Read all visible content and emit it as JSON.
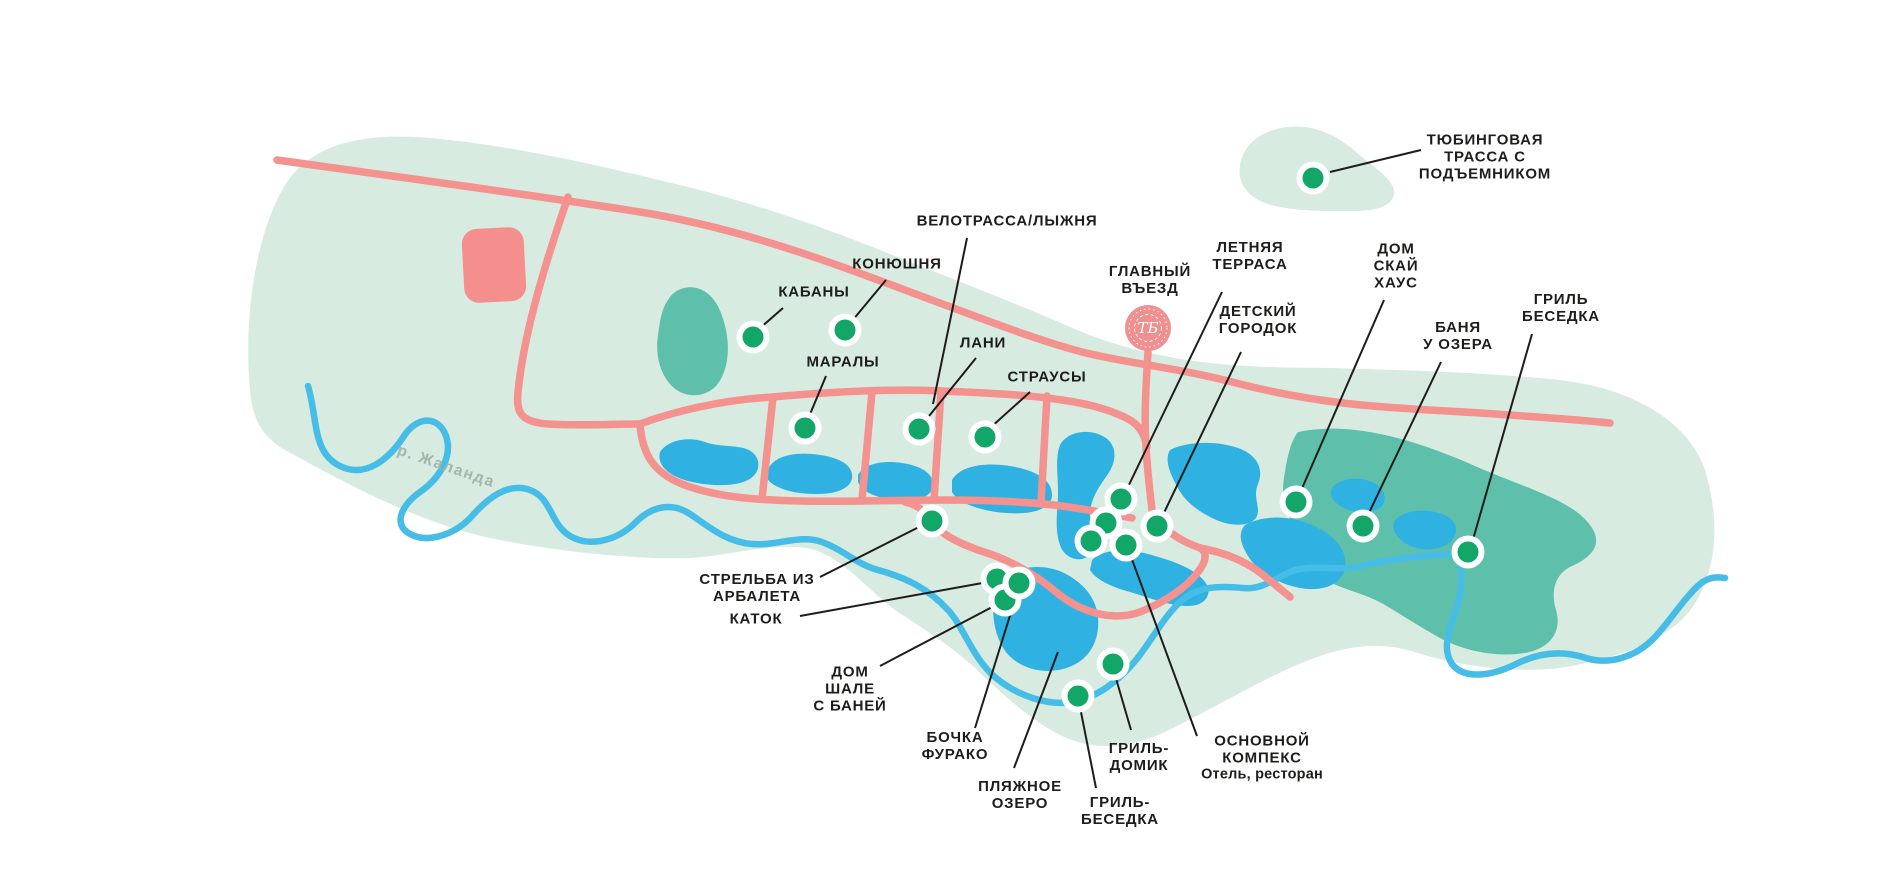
{
  "map": {
    "name": "resort-park-map",
    "colors": {
      "park": "#d8ebe0",
      "forest": "#5ebfab",
      "lake": "#2fb2e2",
      "river": "#45bde7",
      "road": "#f4928f",
      "building": "#f58f8e",
      "logo": "#ee8f90",
      "marker": "#13a669",
      "ring": "#ffffff",
      "text": "#1d1d1b",
      "riverText": "#a3b6a9"
    },
    "river_label": {
      "text": "р. Жаланда",
      "x": 446,
      "y": 467,
      "angle": 19
    },
    "logo": {
      "monogram": "ТБ",
      "x": 1148,
      "y": 328,
      "r": 23
    },
    "markers": [
      {
        "id": "tubing-track",
        "lines": [
          "ТЮБИНГОВАЯ",
          "ТРАССА С",
          "ПОДЪЕМНИКОМ"
        ],
        "label": [
          1485,
          157
        ],
        "leader": [
          1421,
          150,
          1330,
          172
        ],
        "dot": [
          1313,
          178
        ]
      },
      {
        "id": "bike-ski-track",
        "lines": [
          "ВЕЛОТРАССА/ЛЫЖНЯ"
        ],
        "label": [
          1007,
          221
        ],
        "leader": [
          967,
          238,
          933,
          404
        ],
        "dot": null
      },
      {
        "id": "stable",
        "lines": [
          "КОНЮШНЯ"
        ],
        "label": [
          897,
          264
        ],
        "leader": [
          886,
          280,
          852,
          321
        ],
        "dot": [
          845,
          330
        ]
      },
      {
        "id": "boars",
        "lines": [
          "КАБАНЫ"
        ],
        "label": [
          814,
          292
        ],
        "leader": [
          783,
          308,
          759,
          329
        ],
        "dot": [
          753,
          337
        ]
      },
      {
        "id": "marals",
        "lines": [
          "МАРАЛЫ"
        ],
        "label": [
          843,
          362
        ],
        "leader": [
          826,
          376,
          808,
          419
        ],
        "dot": [
          805,
          428
        ]
      },
      {
        "id": "fallow-deer",
        "lines": [
          "ЛАНИ"
        ],
        "label": [
          983,
          343
        ],
        "leader": [
          976,
          358,
          925,
          421
        ],
        "dot": [
          919,
          429
        ]
      },
      {
        "id": "ostriches",
        "lines": [
          "СТРАУСЫ"
        ],
        "label": [
          1047,
          377
        ],
        "leader": [
          1030,
          392,
          990,
          428
        ],
        "dot": [
          985,
          437
        ]
      },
      {
        "id": "main-entrance",
        "lines": [
          "ГЛАВНЫЙ",
          "ВЪЕЗД"
        ],
        "label": [
          1150,
          280
        ],
        "leader": null,
        "dot": null
      },
      {
        "id": "summer-terrace",
        "lines": [
          "ЛЕТНЯЯ",
          "ТЕРРАСА"
        ],
        "label": [
          1250,
          256
        ],
        "leader": [
          1222,
          292,
          1126,
          491
        ],
        "dot": [
          1121,
          499
        ]
      },
      {
        "id": "kids-playground",
        "lines": [
          "ДЕТСКИЙ",
          "ГОРОДОК"
        ],
        "label": [
          1258,
          320
        ],
        "leader": [
          1241,
          352,
          1162,
          517
        ],
        "dot": [
          1157,
          526
        ]
      },
      {
        "id": "sky-house",
        "lines": [
          "ДОМ",
          "СКАЙ",
          "ХАУС"
        ],
        "label": [
          1396,
          266
        ],
        "leader": [
          1384,
          300,
          1300,
          493
        ],
        "dot": [
          1296,
          502
        ]
      },
      {
        "id": "lake-bathhouse",
        "lines": [
          "БАНЯ",
          "У ОЗЕРА"
        ],
        "label": [
          1458,
          336
        ],
        "leader": [
          1441,
          362,
          1367,
          517
        ],
        "dot": [
          1363,
          526
        ]
      },
      {
        "id": "grill-gazebo-east",
        "lines": [
          "ГРИЛЬ",
          "БЕСЕДКА"
        ],
        "label": [
          1561,
          308
        ],
        "leader": [
          1532,
          334,
          1472,
          543
        ],
        "dot": [
          1468,
          552
        ]
      },
      {
        "id": "crossbow-shooting",
        "lines": [
          "СТРЕЛЬБА ИЗ",
          "АРБАЛЕТА"
        ],
        "label": [
          757,
          588
        ],
        "leader": [
          820,
          577,
          923,
          525
        ],
        "dot": [
          932,
          521
        ]
      },
      {
        "id": "skating-rink",
        "lines": [
          "КАТОК"
        ],
        "label": [
          756,
          619
        ],
        "leader": [
          800,
          616,
          988,
          582
        ],
        "dot": [
          997,
          579
        ]
      },
      {
        "id": "chalet-house",
        "lines": [
          "ДОМ",
          "ШАЛЕ",
          "С БАНЕЙ"
        ],
        "label": [
          850,
          689
        ],
        "leader": [
          880,
          666,
          996,
          605
        ],
        "dot": [
          1005,
          600
        ]
      },
      {
        "id": "furako-barrel",
        "lines": [
          "БОЧКА",
          "ФУРАКО"
        ],
        "label": [
          955,
          746
        ],
        "leader": [
          975,
          728,
          1017,
          593
        ],
        "dot": [
          1019,
          583
        ]
      },
      {
        "id": "beach-lake",
        "lines": [
          "ПЛЯЖНОЕ",
          "ОЗЕРО"
        ],
        "label": [
          1020,
          795
        ],
        "leader": [
          1014,
          768,
          1058,
          652
        ],
        "dot": null
      },
      {
        "id": "grill-cabin",
        "lines": [
          "ГРИЛЬ-",
          "ДОМИК"
        ],
        "label": [
          1139,
          757
        ],
        "leader": [
          1131,
          730,
          1115,
          675
        ],
        "dot": [
          1113,
          664
        ]
      },
      {
        "id": "grill-gazebo-south",
        "lines": [
          "ГРИЛЬ-",
          "БЕСЕДКА"
        ],
        "label": [
          1120,
          811
        ],
        "leader": [
          1096,
          788,
          1080,
          707
        ],
        "dot": [
          1078,
          696
        ]
      },
      {
        "id": "main-complex",
        "lines": [
          "ОСНОВНОЙ",
          "КОМПЕКС"
        ],
        "sub": "Отель, ресторан",
        "label": [
          1262,
          758
        ],
        "leader": [
          1197,
          736,
          1130,
          554
        ],
        "dot": [
          1126,
          545
        ]
      }
    ],
    "unlabeled_dots": [
      [
        1106,
        523
      ],
      [
        1091,
        541
      ]
    ]
  }
}
